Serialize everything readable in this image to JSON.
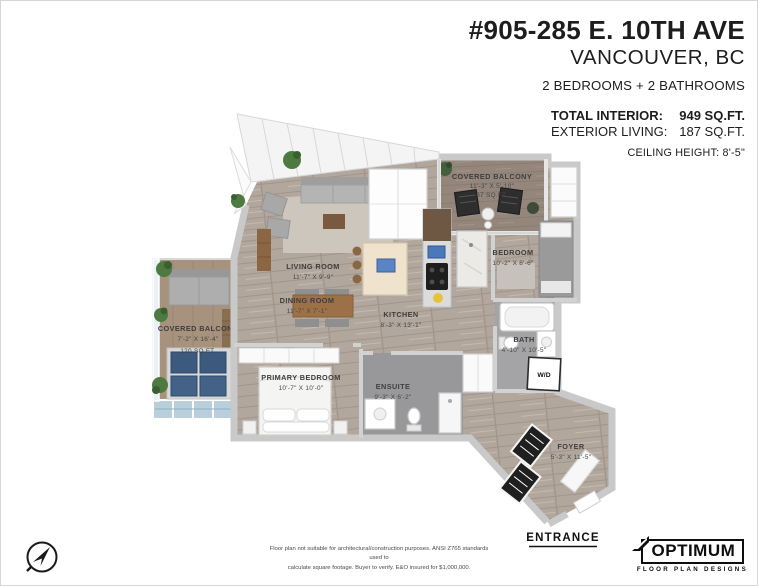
{
  "header": {
    "address_line1": "#905-285 E. 10TH AVE",
    "address_line2": "VANCOUVER, BC",
    "bed_bath_summary": "2 BEDROOMS + 2 BATHROOMS",
    "stats": {
      "total_interior_label": "TOTAL INTERIOR:",
      "total_interior_value": "949 SQ.FT.",
      "exterior_living_label": "EXTERIOR LIVING:",
      "exterior_living_value": "187 SQ.FT.",
      "ceiling_height": "CEILING HEIGHT: 8'-5\""
    }
  },
  "floorplan": {
    "rooms": {
      "living_room": {
        "name": "LIVING ROOM",
        "dims": "11'-7\" X 9'-9\""
      },
      "dining_room": {
        "name": "DINING ROOM",
        "dims": "11'-7\" X 7'-1\""
      },
      "kitchen": {
        "name": "KITCHEN",
        "dims": "8'-3\" X 13'-1\""
      },
      "primary_bedroom": {
        "name": "PRIMARY BEDROOM",
        "dims": "10'-7\" X 10'-0\""
      },
      "ensuite": {
        "name": "ENSUITE",
        "dims": "9'-3\" X 6'-2\""
      },
      "bedroom": {
        "name": "BEDROOM",
        "dims": "10'-2\" X 8'-6\""
      },
      "bath": {
        "name": "BATH",
        "dims": "4'-10\" X 10'-5\""
      },
      "foyer": {
        "name": "FOYER",
        "dims": "5'-3\" X 11'-5\""
      },
      "covered_balcony_right": {
        "name": "COVERED BALCONY",
        "dims": "11'-3\" X 5'-10\"",
        "area": "67 SQ.FT."
      },
      "covered_balcony_left": {
        "name": "COVERED BALCONY",
        "dims": "7'-2\" X 16'-4\"",
        "area": "120 SQ.FT."
      },
      "laundry": {
        "name": "W/D"
      }
    },
    "entrance_label": "ENTRANCE"
  },
  "footer": {
    "disclaimer_line1": "Floor plan not suitable for architectural/construction purposes. ANSI Z765 standards used to",
    "disclaimer_line2": "calculate square footage. Buyer to verify. E&O insured for $1,000,000.",
    "logo": {
      "title": "OPTIMUM",
      "subtitle": "FLOOR PLAN DESIGNS"
    }
  },
  "icons": {
    "compass": "north-arrow-compass",
    "logo_arrow": "optimum-swoosh-arrow"
  },
  "colors": {
    "text_dark": "#1d1d1d",
    "label_gray": "#3e3e3e",
    "wood_floor": "#b2a79d",
    "balcony_deck": "#95867c",
    "patio_floor": "#a7927e",
    "tile_gray": "#a4a4a6",
    "tile_gray_dark": "#98989a",
    "balcony_tile_blue": "#b9d0dc",
    "navy_cushion": "#3c5a7d",
    "wall_gray": "#c9c9c9"
  }
}
